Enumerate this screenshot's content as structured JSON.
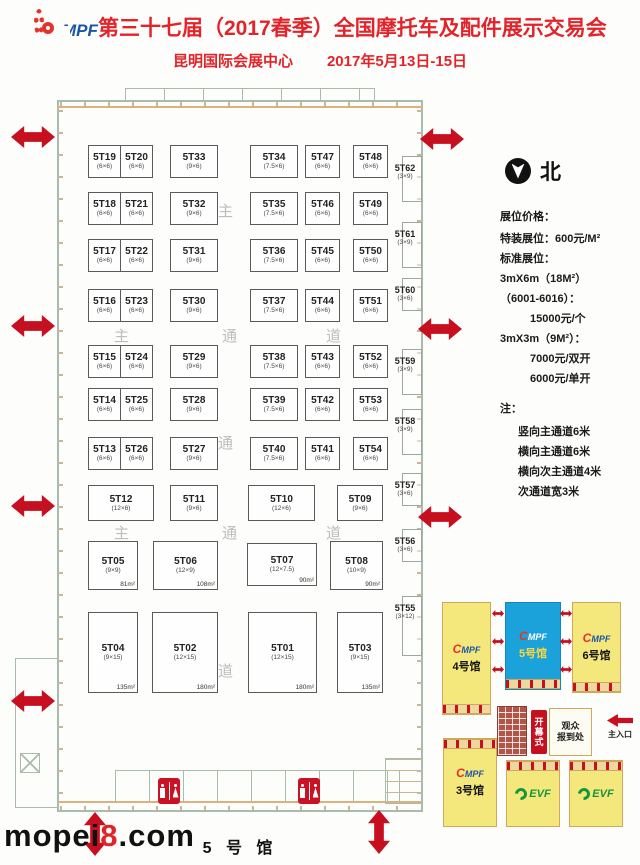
{
  "header": {
    "logo_text": "MPF",
    "title": "第三十七届（2017春季）全国摩托车及配件展示交易会",
    "venue": "昆明国际会展中心",
    "dates": "2017年5月13日-15日"
  },
  "compass": {
    "label": "北"
  },
  "pricing": {
    "title": "展位价格：",
    "lines": [
      "特装展位：600元/M²",
      "标准展位：",
      "3mX6m（18M²）",
      "（6001-6016）：",
      "15000元/个",
      "3mX3m（9M²）：",
      "7000元/双开",
      "6000元/单开"
    ],
    "note_title": "注：",
    "notes": [
      "竖向主通道6米",
      "横向主通道6米",
      "横向次主通道4米",
      "次通道宽3米"
    ]
  },
  "floorplan": {
    "hall_label": "5 号 馆",
    "aisles": {
      "v": [
        "主",
        "通",
        "道"
      ],
      "h1": [
        "主",
        "通",
        "道"
      ],
      "h2": [
        "主",
        "通",
        "道"
      ]
    },
    "upper_booths": [
      {
        "id": "5T19",
        "size": "(6×6)"
      },
      {
        "id": "5T20",
        "size": "(6×6)"
      },
      {
        "id": "5T33",
        "size": "(9×6)"
      },
      {
        "id": "5T34",
        "size": "(7.5×6)"
      },
      {
        "id": "5T47",
        "size": "(6×6)"
      },
      {
        "id": "5T48",
        "size": "(6×6)"
      },
      {
        "id": "5T18",
        "size": "(6×6)"
      },
      {
        "id": "5T21",
        "size": "(6×6)"
      },
      {
        "id": "5T32",
        "size": "(9×6)"
      },
      {
        "id": "5T35",
        "size": "(7.5×6)"
      },
      {
        "id": "5T46",
        "size": "(6×6)"
      },
      {
        "id": "5T49",
        "size": "(6×6)"
      },
      {
        "id": "5T17",
        "size": "(6×6)"
      },
      {
        "id": "5T22",
        "size": "(6×6)"
      },
      {
        "id": "5T31",
        "size": "(9×6)"
      },
      {
        "id": "5T36",
        "size": "(7.5×6)"
      },
      {
        "id": "5T45",
        "size": "(6×6)"
      },
      {
        "id": "5T50",
        "size": "(6×6)"
      },
      {
        "id": "5T16",
        "size": "(6×6)"
      },
      {
        "id": "5T23",
        "size": "(6×6)"
      },
      {
        "id": "5T30",
        "size": "(9×6)"
      },
      {
        "id": "5T37",
        "size": "(7.5×6)"
      },
      {
        "id": "5T44",
        "size": "(6×6)"
      },
      {
        "id": "5T51",
        "size": "(6×6)"
      },
      {
        "id": "5T15",
        "size": "(6×6)"
      },
      {
        "id": "5T24",
        "size": "(6×6)"
      },
      {
        "id": "5T29",
        "size": "(9×6)"
      },
      {
        "id": "5T38",
        "size": "(7.5×6)"
      },
      {
        "id": "5T43",
        "size": "(6×6)"
      },
      {
        "id": "5T52",
        "size": "(6×6)"
      },
      {
        "id": "5T14",
        "size": "(6×6)"
      },
      {
        "id": "5T25",
        "size": "(6×6)"
      },
      {
        "id": "5T28",
        "size": "(9×6)"
      },
      {
        "id": "5T39",
        "size": "(7.5×6)"
      },
      {
        "id": "5T42",
        "size": "(6×6)"
      },
      {
        "id": "5T53",
        "size": "(6×6)"
      },
      {
        "id": "5T13",
        "size": "(6×6)"
      },
      {
        "id": "5T26",
        "size": "(6×6)"
      },
      {
        "id": "5T27",
        "size": "(9×6)"
      },
      {
        "id": "5T40",
        "size": "(7.5×6)"
      },
      {
        "id": "5T41",
        "size": "(6×6)"
      },
      {
        "id": "5T54",
        "size": "(6×6)"
      }
    ],
    "lower_booths": {
      "b12": {
        "id": "5T12",
        "size": "(12×6)"
      },
      "b11": {
        "id": "5T11",
        "size": "(9×6)"
      },
      "b10": {
        "id": "5T10",
        "size": "(12×6)"
      },
      "b09": {
        "id": "5T09",
        "size": "(9×6)"
      },
      "b05": {
        "id": "5T05",
        "size": "(9×9)",
        "area": "81m²"
      },
      "b06": {
        "id": "5T06",
        "size": "(12×9)",
        "area": "108m²"
      },
      "b07": {
        "id": "5T07",
        "size": "(12×7.5)",
        "area": "90m²"
      },
      "b08": {
        "id": "5T08",
        "size": "(10×9)",
        "area": "90m²"
      },
      "b04": {
        "id": "5T04",
        "size": "(9×15)",
        "area": "135m²"
      },
      "b02": {
        "id": "5T02",
        "size": "(12×15)",
        "area": "180m²"
      },
      "b01": {
        "id": "5T01",
        "size": "(12×15)",
        "area": "180m²"
      },
      "b03": {
        "id": "5T03",
        "size": "(9×15)",
        "area": "135m²"
      }
    },
    "side_booths": [
      {
        "id": "5T62",
        "size": "(3×9)"
      },
      {
        "id": "5T61",
        "size": "(3×9)"
      },
      {
        "id": "5T60",
        "size": "(3×6)"
      },
      {
        "id": "5T59",
        "size": "(3×9)"
      },
      {
        "id": "5T58",
        "size": "(3×9)"
      },
      {
        "id": "5T57",
        "size": "(3×6)"
      },
      {
        "id": "5T56",
        "size": "(3×6)"
      },
      {
        "id": "5T55",
        "size": "(3×12)"
      }
    ]
  },
  "minimap": {
    "hall4": {
      "name": "4号馆",
      "logo": "MPF"
    },
    "hall5": {
      "name": "5号馆",
      "logo": "MPF"
    },
    "hall6": {
      "name": "6号馆",
      "logo": "MPF"
    },
    "hall3": {
      "name": "3号馆",
      "logo": "MPF"
    },
    "evf1": {
      "logo": "EVF"
    },
    "evf2": {
      "logo": "EVF"
    },
    "banner": "开幕式",
    "registration": "观众\n报到处",
    "entrance": "主入口"
  },
  "colors": {
    "title_red": "#e2232a",
    "arrow_red": "#c6101f",
    "hall_yellow": "#f4e87c",
    "hall_blue": "#1ba2da",
    "evf_green": "#17953c",
    "logo_blue": "#1c57a5",
    "logo_red": "#e3332b"
  },
  "watermark": {
    "pre": "mopei",
    "num": "8",
    "post": ".com"
  }
}
